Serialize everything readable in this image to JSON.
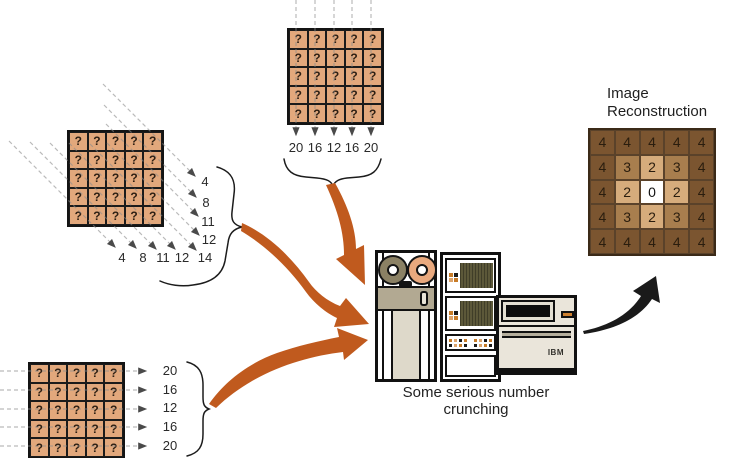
{
  "palette": {
    "cell_tan": "#e2a87c",
    "arrow_orange": "#c05a1e",
    "arrow_black": "#1a1a1a",
    "dashed_ray": "#8c8c8c"
  },
  "grids": {
    "unknown_symbol": "?",
    "size": 5
  },
  "projections": {
    "vertical": {
      "values": [
        "20",
        "16",
        "12",
        "16",
        "20"
      ]
    },
    "diagonal": {
      "side_values": [
        "4",
        "8",
        "11",
        "12"
      ],
      "bottom_values": [
        "4",
        "8",
        "11",
        "12",
        "14"
      ]
    },
    "horizontal": {
      "values": [
        "20",
        "16",
        "12",
        "16",
        "20"
      ]
    }
  },
  "computer": {
    "caption": "Some serious number crunching",
    "ibm_label": "IBM"
  },
  "reconstruction": {
    "title_line1": "Image",
    "title_line2": "Reconstruction",
    "cells": [
      [
        "4",
        "4",
        "4",
        "4",
        "4"
      ],
      [
        "4",
        "3",
        "2",
        "3",
        "4"
      ],
      [
        "4",
        "2",
        "0",
        "2",
        "4"
      ],
      [
        "4",
        "3",
        "2",
        "3",
        "4"
      ],
      [
        "4",
        "4",
        "4",
        "4",
        "4"
      ]
    ],
    "value_colors": {
      "4": "#7b5530",
      "3": "#a87e4e",
      "2": "#d6ac7c",
      "0": "#ffffff"
    },
    "value_text_colors": {
      "4": "#2a1d0e",
      "3": "#2a1d0e",
      "2": "#2a1d0e",
      "0": "#111111"
    }
  }
}
